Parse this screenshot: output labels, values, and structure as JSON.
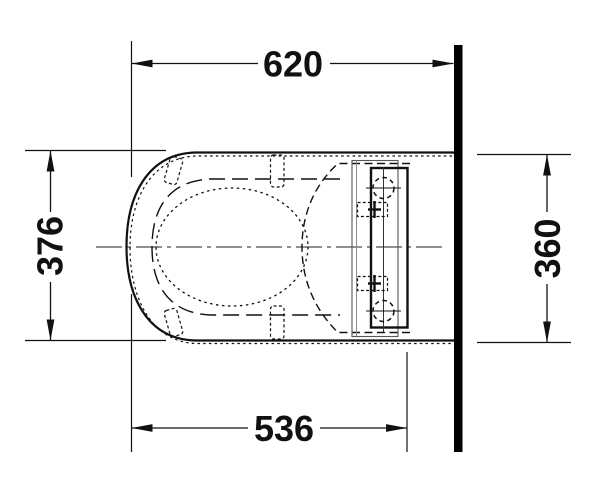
{
  "drawing": {
    "type": "technical-dimension-drawing",
    "subject": "wall-hung toilet with shower seat, top view",
    "dimensions": {
      "top": {
        "value": "620",
        "orientation": "horizontal",
        "measures": "front edge to wall"
      },
      "left": {
        "value": "376",
        "orientation": "vertical",
        "measures": "overall width"
      },
      "right": {
        "value": "360",
        "orientation": "vertical",
        "measures": "width at wall"
      },
      "bottom": {
        "value": "536",
        "orientation": "horizontal",
        "measures": "front edge to ceramic back"
      }
    },
    "colors": {
      "line": "#111111",
      "wall": "#000000",
      "secondary": "#8a8a8a",
      "centerline": "#222222",
      "background": "#ffffff"
    }
  }
}
